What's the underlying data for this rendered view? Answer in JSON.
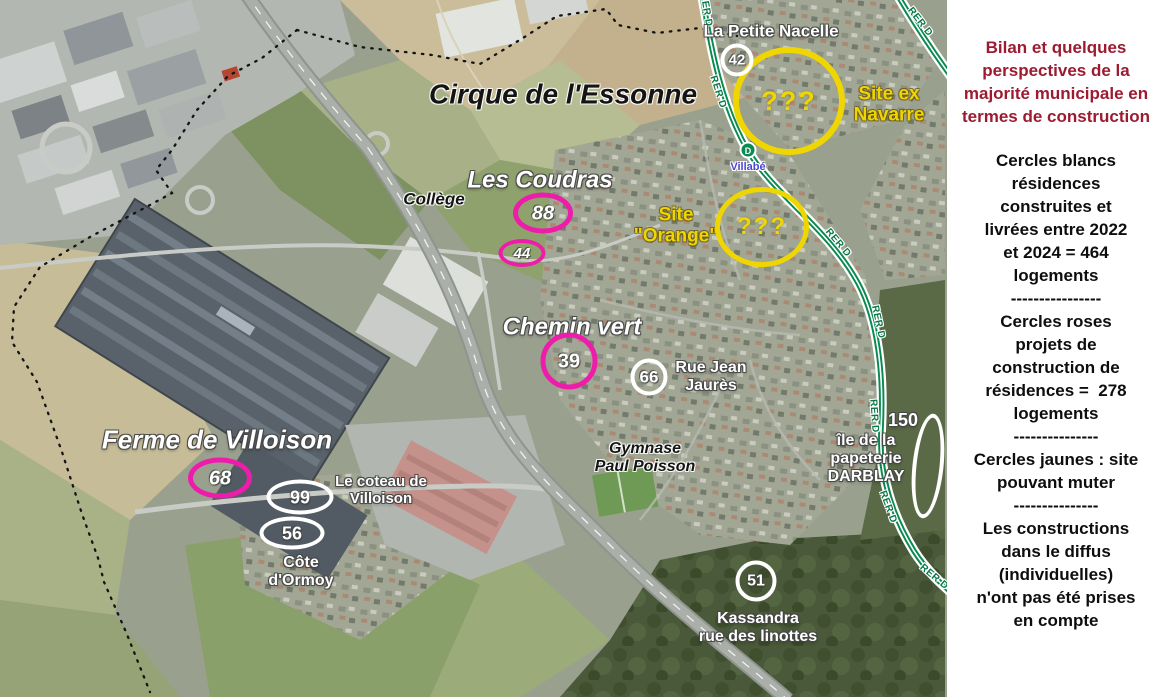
{
  "panel": {
    "title": "Bilan et quelques\nperspectives de la\nmajorité municipale en\ntermes de construction",
    "blocks": [
      "Cercles blancs\nrésidences\nconstruites et\nlivrées entre 2022\net 2024 = 464\nlogements",
      "----------------",
      "Cercles roses\nprojets de\nconstruction de\nrésidences =  278\nlogements",
      "---------------",
      "Cercles jaunes : site\npouvant muter",
      "---------------",
      "Les constructions\ndans le diffus\n(individuelles)\nn'ont pas été prises\nen compte"
    ]
  },
  "map": {
    "area_labels": {
      "cirque": "Cirque de l'Essonne",
      "les_coudras": "Les Coudras",
      "chemin_vert": "Chemin vert",
      "ferme": "Ferme de Villoison",
      "college": "Collège",
      "gymnase": "Gymnase\nPaul Poisson"
    },
    "places": {
      "petite_nacelle": "La Petite Nacelle",
      "rue_jean_jaures": "Rue Jean\nJaurès",
      "coteau": "Le coteau de\nVilloison",
      "cote_ormoy": "Côte\nd'Ormoy",
      "papeterie_value": "150",
      "papeterie": "île de la\npapeterie\nDARBLAY",
      "kassandra": "Kassandra\nrue des linottes"
    },
    "sites": {
      "navarre": {
        "query": "???",
        "label": "Site ex\nNavarre"
      },
      "orange": {
        "query": "???",
        "label": "Site\n\"Orange\""
      }
    },
    "circles": {
      "c42": "42",
      "c88": "88",
      "c44": "44",
      "c39": "39",
      "c66": "66",
      "c68": "68",
      "c99": "99",
      "c56": "56",
      "c51": "51"
    },
    "rer": {
      "line_label": "RER D",
      "station_letter": "D",
      "station_name": "Villabé"
    },
    "colors": {
      "pink": "#ee1caa",
      "yellow": "#f0d600",
      "rer_green": "#0a8a50",
      "title_red": "#9c1b31"
    }
  }
}
